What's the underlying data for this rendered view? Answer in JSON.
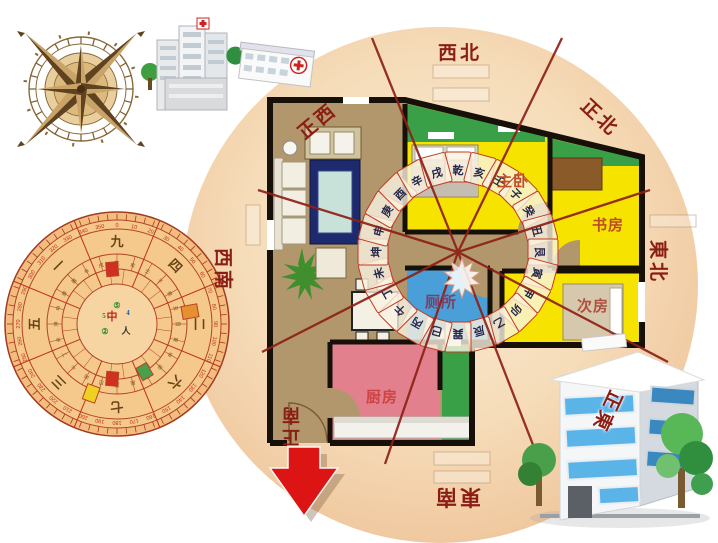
{
  "direction_labels": {
    "nw": "西北",
    "n": "正北",
    "ne": "東北",
    "e": "正東",
    "se": "東南",
    "s": "正南",
    "sw": "西南",
    "w": "正西"
  },
  "room_labels": {
    "master_bedroom": "主卧",
    "study": "书房",
    "second_bedroom": "次房",
    "toilet": "厕所",
    "kitchen": "厨房"
  },
  "ring_24_mountains": [
    "乾",
    "亥",
    "壬",
    "子",
    "癸",
    "丑",
    "艮",
    "寅",
    "甲",
    "卯",
    "乙",
    "辰",
    "巽",
    "巳",
    "丙",
    "午",
    "丁",
    "未",
    "坤",
    "申",
    "庚",
    "酉",
    "辛",
    "戌"
  ],
  "luopan": {
    "degrees": [
      0,
      10,
      20,
      30,
      40,
      50,
      60,
      70,
      80,
      90,
      100,
      110,
      120,
      130,
      140,
      150,
      160,
      170,
      180,
      190,
      200,
      210,
      220,
      230,
      240,
      250,
      260,
      270,
      280,
      290,
      300,
      310,
      320,
      330,
      340,
      350
    ],
    "palace_numbers": [
      "九",
      "四",
      "二",
      "六",
      "七",
      "三",
      "五",
      "一"
    ],
    "center_glyphs": [
      "中",
      "人",
      "②",
      "⑤",
      "4",
      "5"
    ]
  },
  "colors": {
    "background_circle": "#f2d3ab",
    "floor_tan": "#b1976b",
    "room_yellow": "#f6e400",
    "toilet_blue": "#4a9fd8",
    "kitchen_pink": "#e2808e",
    "balcony_green": "#3aa048",
    "wall_black": "#171008",
    "sector_line_red": "#8e2017",
    "label_red": "#8b1d15",
    "arrow_red": "#dd1414",
    "luopan_orange": "#f2bd7e"
  }
}
